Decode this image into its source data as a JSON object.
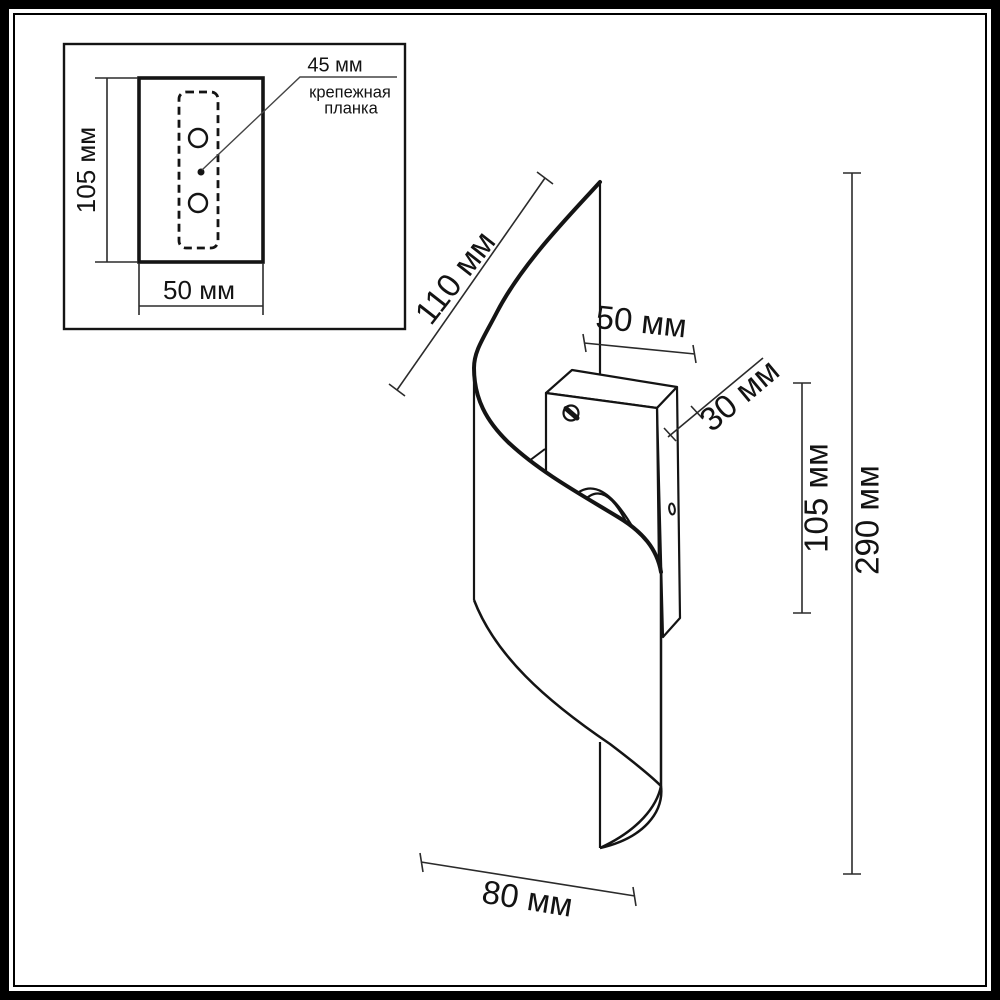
{
  "inset": {
    "height_label": "105 мм",
    "width_label": "50 мм",
    "hole_spacing_label": "45 мм",
    "callout_line1": "крепежная",
    "callout_line2": "планка"
  },
  "main": {
    "top_width_label": "50 мм",
    "depth_label": "30 мм",
    "edge_length_label": "110 мм",
    "bracket_height_label": "105 мм",
    "total_height_label": "290 мм",
    "bottom_width_label": "80 мм"
  },
  "colors": {
    "line": "#141414",
    "dimension_line": "#2b2b2b",
    "background": "#ffffff"
  }
}
